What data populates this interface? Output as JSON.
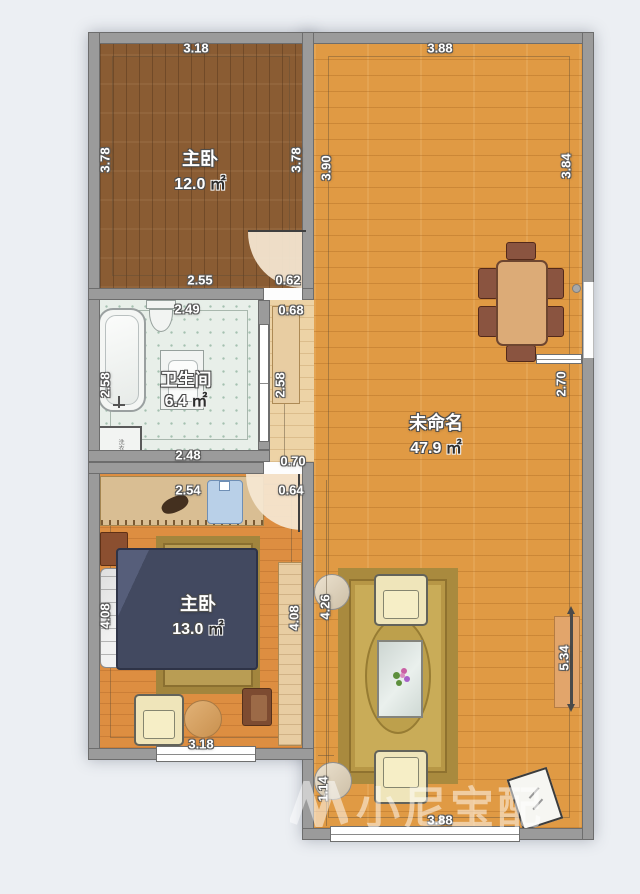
{
  "watermark": {
    "text": "小尼宝配"
  },
  "rooms": {
    "bedroom1": {
      "name": "主卧",
      "area": "12.0",
      "unit": "㎡"
    },
    "bathroom": {
      "name": "卫生间",
      "area": "6.4",
      "unit": "㎡"
    },
    "bedroom2": {
      "name": "主卧",
      "area": "13.0",
      "unit": "㎡"
    },
    "living": {
      "name": "未命名",
      "area": "47.9",
      "unit": "㎡"
    }
  },
  "fixtures": {
    "washer": "洗衣机"
  },
  "dims": {
    "bedroom1_top": "3.18",
    "living_top": "3.88",
    "bedroom1_left": "3.78",
    "bedroom1_right": "3.78",
    "living_left": "3.90",
    "living_right": "3.84",
    "bedroom1_bottom": "2.55",
    "bedroom1_door": "0.62",
    "hall_top": "0.68",
    "bathroom_top": "2.49",
    "bathroom_left": "2.58",
    "hall_right": "2.58",
    "bathroom_bottom": "2.48",
    "hall_bottom": "0.70",
    "bedroom2_top": "2.54",
    "bedroom2_door": "0.64",
    "bedroom2_left": "4.08",
    "bedroom2_right": "4.08",
    "living_mid_left": "4.26",
    "dining_opening": "2.70",
    "living_right_lower": "5.34",
    "bedroom2_window": "3.18",
    "living_bottom_left": "1.14",
    "living_bottom": "3.88"
  },
  "colors": {
    "wall": "#9b9b9b",
    "bedroom1_floor": "#8a5c33",
    "living_floor": "#e09a44",
    "bedroom2_floor": "#dd8e41",
    "bathroom_floor": "#e8efe9",
    "rug": "#b79746",
    "bed": "#424960",
    "background": "#eceff3"
  }
}
